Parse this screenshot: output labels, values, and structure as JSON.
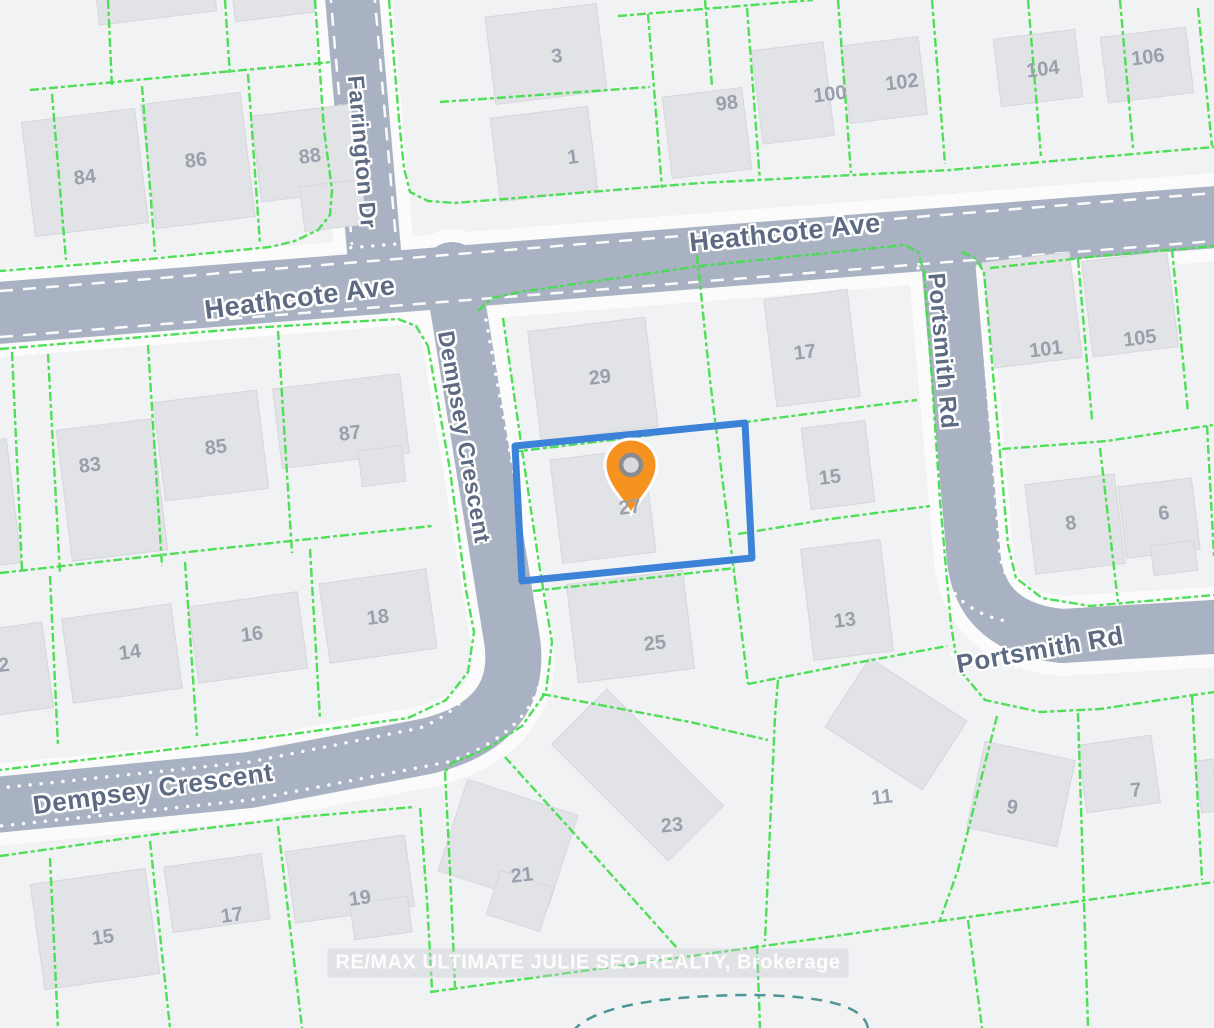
{
  "map": {
    "background": "#f1f2f4",
    "road_color": "#a9b2c2",
    "road_margin_color": "#fbfbfc",
    "parcel_line_color": "#44dd4e",
    "building_color": "#e2e3e7",
    "building_border": "#d6d7db",
    "lot_label_color": "#99a0ab",
    "road_label_color": "#5d6a82",
    "highlight_color": "#3b82d8",
    "marker_color": "#f6921e",
    "marker_hole_fill": "#d9dadc",
    "marker_hole_ring": "#8a8b90",
    "cul_de_sac_color": "#4e9596",
    "watermark": {
      "text": "RE/MAX ULTIMATE JULIE SEO REALTY, Brokerage"
    }
  },
  "roads": [
    {
      "name": "heathcote-ave",
      "path": "M -15 314 L 1229 216",
      "width": 62
    },
    {
      "name": "farrington-dr",
      "path": "M 351 -15 L 375 262",
      "width": 54
    },
    {
      "name": "dempsey-crescent",
      "path": "M 452 270 L 512 640 Q 524 722 428 746 L 250 780 L -15 806",
      "width": 56
    },
    {
      "name": "portsmith-rd",
      "path": "M 946 238 L 974 560 Q 982 628 1062 636 L 1229 626",
      "width": 54
    }
  ],
  "road_markings": {
    "dashed": [
      "M 0 291 L 1214 193",
      "M 0 337 L 1214 241",
      "M 330 -10 L 352 245",
      "M 374 -10 L 396 240"
    ],
    "dotted": [
      "M 0 276 L 1214 178",
      "M 0 356 L 418 322",
      "M 524 311 L 900 281",
      "M 1002 271 L 1214 252",
      "M 320 -10 L 343 235",
      "M 384 -10 L 406 230",
      "M 424 330 L 479 640 Q 488 700 420 728 L 250 762 L 0 788",
      "M 486 320 L 544 640 Q 552 726 448 762 L 250 800 L 0 826",
      "M 918 268 L 941 560 Q 948 610 1010 622",
      "M 978 266 L 1000 555 Q 1006 600 1068 607 L 1214 597",
      "M 952 655 Q 968 668 1062 668 L 1214 657"
    ]
  },
  "parcel_lines": [
    [
      [
        30,
        90
      ],
      [
        200,
        74
      ],
      [
        332,
        62
      ]
    ],
    [
      [
        108,
        0
      ],
      [
        112,
        88
      ]
    ],
    [
      [
        225,
        0
      ],
      [
        230,
        76
      ]
    ],
    [
      [
        52,
        94
      ],
      [
        66,
        260
      ]
    ],
    [
      [
        142,
        86
      ],
      [
        155,
        252
      ]
    ],
    [
      [
        248,
        74
      ],
      [
        260,
        244
      ]
    ],
    [
      [
        315,
        0
      ],
      [
        324,
        130
      ],
      [
        332,
        190
      ],
      [
        330,
        215
      ],
      [
        318,
        230
      ],
      [
        295,
        241
      ],
      [
        270,
        247
      ],
      [
        150,
        259
      ],
      [
        0,
        271
      ]
    ],
    [
      [
        389,
        0
      ],
      [
        399,
        120
      ],
      [
        404,
        168
      ],
      [
        410,
        192
      ],
      [
        428,
        201
      ],
      [
        455,
        203
      ],
      [
        700,
        183
      ],
      [
        950,
        170
      ],
      [
        1214,
        147
      ]
    ],
    [
      [
        440,
        102
      ],
      [
        650,
        87
      ]
    ],
    [
      [
        705,
        0
      ],
      [
        712,
        86
      ]
    ],
    [
      [
        618,
        16
      ],
      [
        813,
        0
      ]
    ],
    [
      [
        648,
        14
      ],
      [
        662,
        188
      ]
    ],
    [
      [
        747,
        8
      ],
      [
        760,
        181
      ]
    ],
    [
      [
        838,
        0
      ],
      [
        851,
        173
      ]
    ],
    [
      [
        932,
        0
      ],
      [
        945,
        164
      ]
    ],
    [
      [
        1028,
        0
      ],
      [
        1041,
        156
      ]
    ],
    [
      [
        1120,
        0
      ],
      [
        1133,
        148
      ]
    ],
    [
      [
        1198,
        8
      ],
      [
        1212,
        146
      ]
    ],
    [
      [
        0,
        349
      ],
      [
        250,
        328
      ],
      [
        398,
        319
      ],
      [
        416,
        326
      ],
      [
        428,
        346
      ]
    ],
    [
      [
        12,
        352
      ],
      [
        22,
        570
      ]
    ],
    [
      [
        48,
        354
      ],
      [
        60,
        574
      ]
    ],
    [
      [
        148,
        345
      ],
      [
        162,
        566
      ]
    ],
    [
      [
        278,
        331
      ],
      [
        292,
        553
      ]
    ],
    [
      [
        0,
        573
      ],
      [
        215,
        549
      ],
      [
        432,
        526
      ]
    ],
    [
      [
        50,
        576
      ],
      [
        58,
        746
      ]
    ],
    [
      [
        185,
        562
      ],
      [
        197,
        736
      ]
    ],
    [
      [
        310,
        549
      ],
      [
        320,
        719
      ]
    ],
    [
      [
        428,
        346
      ],
      [
        450,
        470
      ],
      [
        466,
        590
      ],
      [
        474,
        632
      ],
      [
        468,
        672
      ],
      [
        446,
        700
      ],
      [
        408,
        718
      ],
      [
        300,
        733
      ],
      [
        150,
        752
      ],
      [
        0,
        770
      ]
    ],
    [
      [
        0,
        856
      ],
      [
        150,
        835
      ],
      [
        300,
        817
      ],
      [
        414,
        807
      ]
    ],
    [
      [
        50,
        858
      ],
      [
        58,
        1028
      ]
    ],
    [
      [
        150,
        841
      ],
      [
        170,
        1028
      ]
    ],
    [
      [
        278,
        826
      ],
      [
        302,
        1028
      ]
    ],
    [
      [
        420,
        808
      ],
      [
        427,
        900
      ],
      [
        432,
        990
      ]
    ],
    [
      [
        445,
        772
      ],
      [
        450,
        870
      ],
      [
        455,
        987
      ]
    ],
    [
      [
        430,
        992
      ],
      [
        800,
        941
      ],
      [
        1214,
        882
      ]
    ],
    [
      [
        503,
        318
      ],
      [
        522,
        450
      ],
      [
        540,
        570
      ],
      [
        552,
        642
      ],
      [
        546,
        692
      ],
      [
        522,
        726
      ],
      [
        488,
        748
      ],
      [
        452,
        763
      ],
      [
        445,
        772
      ]
    ],
    [
      [
        478,
        311
      ],
      [
        492,
        298
      ],
      [
        520,
        292
      ],
      [
        700,
        266
      ],
      [
        905,
        245
      ],
      [
        918,
        252
      ],
      [
        924,
        272
      ]
    ],
    [
      [
        924,
        272
      ],
      [
        932,
        380
      ],
      [
        940,
        500
      ],
      [
        947,
        580
      ],
      [
        951,
        625
      ],
      [
        958,
        668
      ],
      [
        985,
        700
      ],
      [
        1040,
        712
      ],
      [
        1100,
        709
      ],
      [
        1214,
        692
      ]
    ],
    [
      [
        695,
        236
      ],
      [
        710,
        380
      ],
      [
        725,
        500
      ],
      [
        740,
        620
      ],
      [
        748,
        684
      ]
    ],
    [
      [
        512,
        452
      ],
      [
        620,
        439
      ],
      [
        715,
        427
      ]
    ],
    [
      [
        533,
        591
      ],
      [
        640,
        579
      ],
      [
        735,
        568
      ]
    ],
    [
      [
        542,
        694
      ],
      [
        690,
        722
      ],
      [
        768,
        740
      ]
    ],
    [
      [
        723,
        425
      ],
      [
        830,
        411
      ],
      [
        917,
        400
      ]
    ],
    [
      [
        738,
        534
      ],
      [
        830,
        519
      ],
      [
        930,
        506
      ]
    ],
    [
      [
        748,
        684
      ],
      [
        850,
        664
      ],
      [
        947,
        646
      ]
    ],
    [
      [
        778,
        680
      ],
      [
        775,
        716
      ],
      [
        765,
        941
      ]
    ],
    [
      [
        757,
        945
      ],
      [
        760,
        1028
      ]
    ],
    [
      [
        505,
        757
      ],
      [
        600,
        862
      ],
      [
        677,
        948
      ]
    ],
    [
      [
        997,
        716
      ],
      [
        958,
        870
      ],
      [
        940,
        920
      ]
    ],
    [
      [
        968,
        920
      ],
      [
        982,
        1028
      ]
    ],
    [
      [
        1078,
        713
      ],
      [
        1088,
        1028
      ]
    ],
    [
      [
        1192,
        696
      ],
      [
        1202,
        880
      ]
    ],
    [
      [
        962,
        252
      ],
      [
        975,
        258
      ],
      [
        984,
        272
      ],
      [
        998,
        430
      ],
      [
        1008,
        545
      ],
      [
        1016,
        578
      ],
      [
        1042,
        598
      ],
      [
        1090,
        606
      ],
      [
        1214,
        595
      ]
    ],
    [
      [
        990,
        268
      ],
      [
        1100,
        256
      ],
      [
        1214,
        246
      ]
    ],
    [
      [
        1078,
        259
      ],
      [
        1092,
        420
      ]
    ],
    [
      [
        1172,
        249
      ],
      [
        1188,
        412
      ]
    ],
    [
      [
        1002,
        449
      ],
      [
        1107,
        441
      ],
      [
        1213,
        425
      ]
    ],
    [
      [
        1100,
        448
      ],
      [
        1118,
        602
      ]
    ],
    [
      [
        1207,
        426
      ],
      [
        1214,
        556
      ]
    ]
  ],
  "buildings": [
    [
      97,
      -18,
      118,
      36,
      -7
    ],
    [
      233,
      -20,
      80,
      37,
      -7
    ],
    [
      28,
      115,
      114,
      115,
      -7
    ],
    [
      148,
      98,
      100,
      125,
      -7
    ],
    [
      256,
      110,
      100,
      86,
      -7
    ],
    [
      302,
      183,
      62,
      45,
      -7
    ],
    [
      490,
      10,
      112,
      88,
      -7
    ],
    [
      495,
      112,
      98,
      84,
      -7
    ],
    [
      667,
      92,
      80,
      82,
      -7
    ],
    [
      757,
      46,
      72,
      94,
      -7
    ],
    [
      845,
      41,
      78,
      78,
      -7
    ],
    [
      997,
      34,
      82,
      68,
      -7
    ],
    [
      1104,
      32,
      86,
      66,
      -7
    ],
    [
      988,
      257,
      88,
      106,
      -7
    ],
    [
      1087,
      256,
      86,
      96,
      -7
    ],
    [
      1030,
      479,
      90,
      90,
      -7
    ],
    [
      1122,
      482,
      74,
      72,
      -7
    ],
    [
      1152,
      543,
      44,
      30,
      -7
    ],
    [
      -30,
      627,
      78,
      86,
      -8
    ],
    [
      -20,
      440,
      34,
      125,
      -7
    ],
    [
      64,
      424,
      96,
      132,
      -7
    ],
    [
      159,
      396,
      104,
      99,
      -7
    ],
    [
      277,
      381,
      128,
      80,
      -7
    ],
    [
      360,
      448,
      44,
      36,
      -7
    ],
    [
      67,
      611,
      110,
      85,
      -8
    ],
    [
      193,
      599,
      110,
      77,
      -8
    ],
    [
      324,
      576,
      108,
      80,
      -8
    ],
    [
      534,
      324,
      118,
      110,
      -7
    ],
    [
      770,
      294,
      84,
      108,
      -7
    ],
    [
      806,
      424,
      64,
      82,
      -7
    ],
    [
      807,
      544,
      80,
      112,
      -7
    ],
    [
      556,
      454,
      94,
      104,
      -7
    ],
    [
      572,
      577,
      117,
      99,
      -7
    ],
    [
      555,
      736,
      165,
      78,
      45
    ],
    [
      450,
      795,
      116,
      96,
      18
    ],
    [
      492,
      878,
      56,
      46,
      18
    ],
    [
      290,
      843,
      120,
      72,
      -8
    ],
    [
      352,
      900,
      58,
      36,
      -8
    ],
    [
      168,
      860,
      98,
      66,
      -8
    ],
    [
      37,
      876,
      116,
      106,
      -8
    ],
    [
      838,
      683,
      116,
      82,
      33
    ],
    [
      975,
      750,
      92,
      88,
      12
    ],
    [
      1082,
      740,
      74,
      68,
      -8
    ],
    [
      1198,
      760,
      18,
      52,
      -8
    ]
  ],
  "lots": [
    {
      "n": "84",
      "x": 85,
      "y": 178,
      "rot": -7
    },
    {
      "n": "86",
      "x": 196,
      "y": 161,
      "rot": -7
    },
    {
      "n": "88",
      "x": 310,
      "y": 157,
      "rot": -7
    },
    {
      "n": "3",
      "x": 557,
      "y": 57,
      "rot": -7
    },
    {
      "n": "1",
      "x": 573,
      "y": 158,
      "rot": -7
    },
    {
      "n": "98",
      "x": 727,
      "y": 104,
      "rot": -7
    },
    {
      "n": "100",
      "x": 830,
      "y": 95,
      "rot": -7
    },
    {
      "n": "102",
      "x": 902,
      "y": 83,
      "rot": -7
    },
    {
      "n": "104",
      "x": 1043,
      "y": 70,
      "rot": -7
    },
    {
      "n": "106",
      "x": 1148,
      "y": 58,
      "rot": -7
    },
    {
      "n": "83",
      "x": 90,
      "y": 466,
      "rot": -7
    },
    {
      "n": "85",
      "x": 216,
      "y": 448,
      "rot": -7
    },
    {
      "n": "87",
      "x": 350,
      "y": 434,
      "rot": -7
    },
    {
      "n": "2",
      "x": 4,
      "y": 666,
      "rot": -7
    },
    {
      "n": "14",
      "x": 130,
      "y": 653,
      "rot": -7
    },
    {
      "n": "16",
      "x": 252,
      "y": 635,
      "rot": -7
    },
    {
      "n": "18",
      "x": 378,
      "y": 618,
      "rot": -7
    },
    {
      "n": "29",
      "x": 600,
      "y": 378,
      "rot": -7
    },
    {
      "n": "27",
      "x": 630,
      "y": 508,
      "rot": -7
    },
    {
      "n": "25",
      "x": 655,
      "y": 644,
      "rot": -7
    },
    {
      "n": "23",
      "x": 672,
      "y": 826,
      "rot": -5
    },
    {
      "n": "21",
      "x": 522,
      "y": 876,
      "rot": -7
    },
    {
      "n": "19",
      "x": 360,
      "y": 899,
      "rot": -8
    },
    {
      "n": "17",
      "x": 232,
      "y": 916,
      "rot": -8
    },
    {
      "n": "15",
      "x": 103,
      "y": 938,
      "rot": -8
    },
    {
      "n": "17",
      "x": 805,
      "y": 353,
      "rot": -7
    },
    {
      "n": "15",
      "x": 830,
      "y": 478,
      "rot": -7
    },
    {
      "n": "13",
      "x": 845,
      "y": 621,
      "rot": -7
    },
    {
      "n": "11",
      "x": 882,
      "y": 798,
      "rot": -7
    },
    {
      "n": "9",
      "x": 1012,
      "y": 808,
      "rot": 10
    },
    {
      "n": "7",
      "x": 1136,
      "y": 791,
      "rot": -7
    },
    {
      "n": "101",
      "x": 1046,
      "y": 350,
      "rot": -7
    },
    {
      "n": "105",
      "x": 1140,
      "y": 339,
      "rot": -7
    },
    {
      "n": "8",
      "x": 1071,
      "y": 524,
      "rot": -7
    },
    {
      "n": "6",
      "x": 1164,
      "y": 514,
      "rot": -7
    }
  ],
  "lot_label_size": 20,
  "road_labels": [
    {
      "text": "Heathcote Ave",
      "x": 300,
      "y": 298,
      "rot": -7.5,
      "size": 27
    },
    {
      "text": "Heathcote Ave",
      "x": 785,
      "y": 233,
      "rot": -6,
      "size": 27
    },
    {
      "text": "Farrington Dr",
      "x": 362,
      "y": 152,
      "rot": 85,
      "size": 23
    },
    {
      "text": "Dempsey Crescent",
      "x": 464,
      "y": 437,
      "rot": 80,
      "size": 23
    },
    {
      "text": "Dempsey Crescent",
      "x": 153,
      "y": 789,
      "rot": -8,
      "size": 26
    },
    {
      "text": "Portsmith Rd",
      "x": 942,
      "y": 351,
      "rot": 85,
      "size": 24
    },
    {
      "text": "Portsmith Rd",
      "x": 1040,
      "y": 650,
      "rot": -10,
      "size": 26
    }
  ],
  "highlight": {
    "points": "515,446 745,423 752,558 522,581",
    "stroke_width": 7
  },
  "marker": {
    "x": 631,
    "y": 514
  },
  "cul_de_sac": {
    "path": "M 572 1032 Q 600 997 745 995 Q 870 995 868 1032"
  }
}
